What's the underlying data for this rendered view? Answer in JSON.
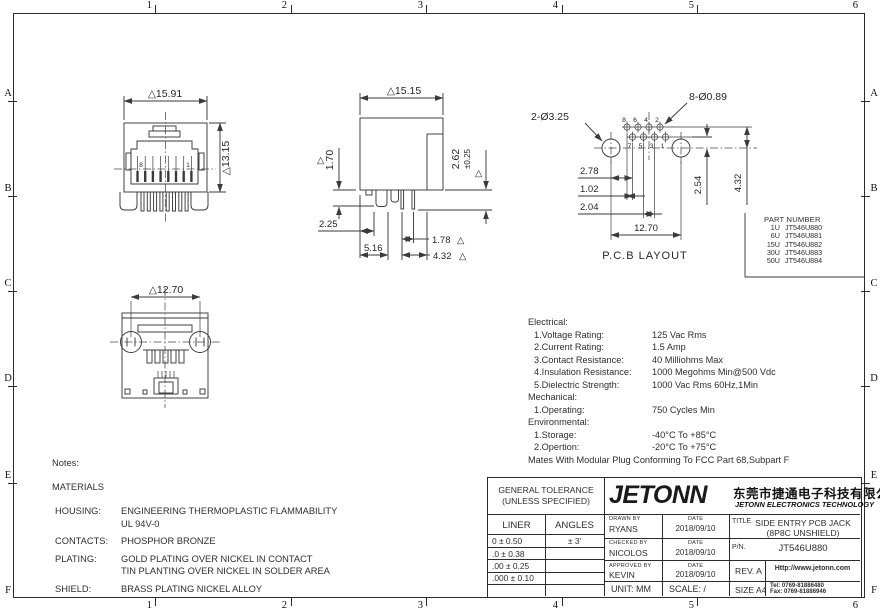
{
  "frame": {
    "cols": [
      "1",
      "2",
      "3",
      "4",
      "5",
      "6"
    ],
    "rows": [
      "A",
      "B",
      "C",
      "D",
      "E",
      "F"
    ]
  },
  "views": {
    "front": {
      "dim_width": "△15.91",
      "dim_height": "△13.15",
      "pin_left": "8",
      "pin_right": "1"
    },
    "side": {
      "dim_width": "△15.15",
      "tri": "△",
      "dim_step": "1.70",
      "dim_pin": "2.62",
      "dim_pin_tol": "±0.25",
      "dim_a": "2.25",
      "dim_b": "5.16",
      "dim_c": "1.78",
      "dim_d": "4.32"
    },
    "pcb": {
      "title": "P.C.B  LAYOUT",
      "callout_small": "8-Ø0.89",
      "callout_big": "2-Ø3.25",
      "dim_a": "2.78",
      "dim_b": "1.02",
      "dim_c": "2.04",
      "dim_d": "12.70",
      "dim_e": "2.54",
      "dim_f": "4.32",
      "pins_top": [
        "8",
        "6",
        "4",
        "2"
      ],
      "pins_bottom": [
        "7",
        "5",
        "3",
        "1"
      ]
    },
    "bottom": {
      "dim_width": "△12.70"
    }
  },
  "part_table": {
    "title": "PART NUMBER",
    "rows": [
      {
        "u": "1U",
        "pn": "JT546U880"
      },
      {
        "u": "6U",
        "pn": "JT546U881"
      },
      {
        "u": "15U",
        "pn": "JT546U882"
      },
      {
        "u": "30U",
        "pn": "JT546U883"
      },
      {
        "u": "50U",
        "pn": "JT546U884"
      }
    ]
  },
  "specs": {
    "electrical_title": "Electrical:",
    "rows_e": [
      {
        "l": "1.Voltage Rating:",
        "v": "125 Vac Rms"
      },
      {
        "l": "2.Current Rating:",
        "v": "1.5 Amp"
      },
      {
        "l": "3.Contact Resistance:",
        "v": "40 Milliohms Max"
      },
      {
        "l": "4.Insulation Resistance:",
        "v": "1000 Megohms Min@500 Vdc"
      },
      {
        "l": "5.Dielectric Strength:",
        "v": "1000 Vac Rms 60Hz,1Min"
      }
    ],
    "mechanical_title": "Mechanical:",
    "rows_m": [
      {
        "l": "1.Operating:",
        "v": "750 Cycles Min"
      }
    ],
    "environmental_title": "Environmental:",
    "rows_v": [
      {
        "l": "1.Storage:",
        "v": "-40°C To +85°C"
      },
      {
        "l": "2.Opertion:",
        "v": "-20°C To +75°C"
      }
    ],
    "footnote": "Mates With Modular Plug Conforming To FCC Part 68,Subpart F"
  },
  "notes": {
    "title": "Notes:",
    "materials": "MATERIALS",
    "rows": [
      {
        "label": "HOUSING:",
        "line1": "ENGINEERING THERMOPLASTIC FLAMMABILITY",
        "line2": "UL 94V-0"
      },
      {
        "label": "CONTACTS:",
        "line1": "PHOSPHOR BRONZE",
        "line2": ""
      },
      {
        "label": "PLATING:",
        "line1": "GOLD PLATING OVER NICKEL IN CONTACT",
        "line2": "TIN PLANTING OVER NICKEL IN SOLDER AREA"
      },
      {
        "label": "SHIELD:",
        "line1": "BRASS PLATING NICKEL ALLOY",
        "line2": ""
      }
    ]
  },
  "title_block": {
    "tol_header1": "GENERAL TOLERANCE",
    "tol_header2": "(UNLESS SPECIFIED)",
    "liner": "LINER",
    "angles": "ANGLES",
    "tol_rows": [
      {
        "liner": "0    ±  0.50",
        "angle": "±  3'"
      },
      {
        "liner": ".0   ±  0.38",
        "angle": ""
      },
      {
        "liner": ".00  ±  0.25",
        "angle": ""
      },
      {
        "liner": ".000 ±  0.10",
        "angle": ""
      }
    ],
    "unit": "UNIT:  MM",
    "scale": "SCALE:  /",
    "logo": "JETONN",
    "company_cn": "东莞市捷通电子科技有限公司",
    "company_en": "JETONN ELECTRONICS TECHNOLOGY",
    "drawn_label": "DRAWN BY",
    "drawn": "RYANS",
    "date_label": "DATE",
    "drawn_date": "2018/09/10",
    "checked_label": "CHECKED BY",
    "checked": "NICOLOS",
    "checked_date": "2018/09/10",
    "approved_label": "APPROVED BY",
    "approved": "KEVIN",
    "approved_date": "2018/09/10",
    "title_label": "TITLE.",
    "title1": "SIDE ENTRY PCB JACK",
    "title2": "(8P8C UNSHIELD)",
    "pn_label": "P/N.",
    "pn": "JT546U880",
    "rev": "REV.  A",
    "size": "SIZE  A4",
    "website": "Http://www.jetonn.com",
    "tel": "Tel:  0769-81886480",
    "fax": "Fax:  0769-81886946"
  }
}
